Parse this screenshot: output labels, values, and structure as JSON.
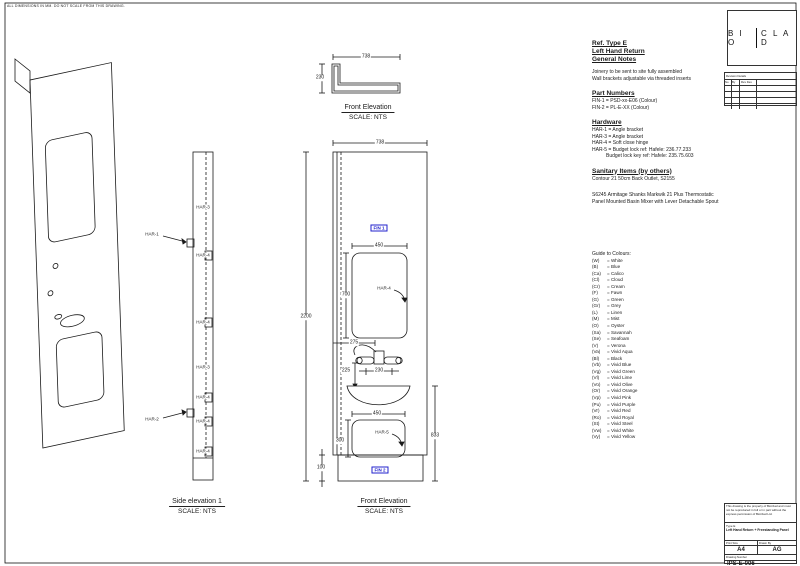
{
  "sheet": {
    "top_note": "ALL DIMENSIONS IN MM. DO NOT SCALE FROM THIS DRAWING."
  },
  "logo": {
    "part1": "B I O",
    "part2": "C L A D"
  },
  "revisions": {
    "title": "Revision Details",
    "col1": "No",
    "col2": "By",
    "col3": "Rev Des"
  },
  "ref_notes": {
    "line1": "Ref. Type E",
    "line2": "Left Hand Return",
    "line3": "General Notes",
    "note1": "Joinery to be sent to site fully assembled",
    "note2": "Wall brackets adjustable via threaded inserts"
  },
  "part_numbers": {
    "title": "Part Numbers",
    "item1": "FIN-1 = PSD-xx-E06 (Colour)",
    "item2": "FIN-2 = PL-E-XX (Colour)"
  },
  "hardware": {
    "title": "Hardware",
    "item1": "HAR-1 = Angle bracket",
    "item2": "HAR-3 = Angle bracket",
    "item3": "HAR-4 = Soft close hinge",
    "item4": "HAR-5 = Budget lock ref: Hafele: 236.77.233",
    "item5": "Budget lock key ref: Hafele: 235.75.603"
  },
  "sanitary": {
    "title": "Sanitary Items (by others)",
    "item1": "Contour 21 50cm Back Outlet, S2155",
    "item2": "S6245 Armitage Shanks Markwik 21 Plus Thermostatic Panel Mounted Basin Mixer with Lever Detachable Spout"
  },
  "colours": {
    "title": "Guide to Colours:",
    "items": [
      {
        "code": "(W)",
        "name": "= White"
      },
      {
        "code": "(B)",
        "name": "= Blue"
      },
      {
        "code": "(Ca)",
        "name": "= Calico"
      },
      {
        "code": "(Cl)",
        "name": "= Cloud"
      },
      {
        "code": "(Cr)",
        "name": "= Cream"
      },
      {
        "code": "(F)",
        "name": "= Fawn"
      },
      {
        "code": "(G)",
        "name": "= Green"
      },
      {
        "code": "(Gr)",
        "name": "= Grey"
      },
      {
        "code": "(L)",
        "name": "= Linen"
      },
      {
        "code": "(M)",
        "name": "= Mist"
      },
      {
        "code": "(O)",
        "name": "= Oyster"
      },
      {
        "code": "(Sa)",
        "name": "= Savannah"
      },
      {
        "code": "(Se)",
        "name": "= Seafoam"
      },
      {
        "code": "(V)",
        "name": "= Verona"
      },
      {
        "code": "(Va)",
        "name": "= Vivid Aqua"
      },
      {
        "code": "(Bl)",
        "name": "= Black"
      },
      {
        "code": "(Vb)",
        "name": "= Vivid Blue"
      },
      {
        "code": "(Vg)",
        "name": "= Vivid Green"
      },
      {
        "code": "(Vl)",
        "name": "= Vivid Lime"
      },
      {
        "code": "(Vo)",
        "name": "= Vivid Olive"
      },
      {
        "code": "(Or)",
        "name": "= Vivid Orange"
      },
      {
        "code": "(Vp)",
        "name": "= Vivid Pink"
      },
      {
        "code": "(Pu)",
        "name": "= Vivid Purple"
      },
      {
        "code": "(Vr)",
        "name": "= Vivid Red"
      },
      {
        "code": "(Ro)",
        "name": "= Vivid Royal"
      },
      {
        "code": "(St)",
        "name": "= Vivid Steel"
      },
      {
        "code": "(Vw)",
        "name": "= Vivid White"
      },
      {
        "code": "(Vy)",
        "name": "= Vivid Yellow"
      }
    ]
  },
  "views": {
    "plan": {
      "caption": "Front Elevation",
      "scale": "SCALE: NTS",
      "dim_width": "738",
      "dim_depth": "230"
    },
    "side": {
      "caption": "Side elevation 1",
      "scale": "SCALE: NTS",
      "leader_top": "HAR-1",
      "leader_bottom": "HAR-2",
      "labels": [
        "HAR-3",
        "HAR-4",
        "HAR-4",
        "HAR-3",
        "HAR-4",
        "HAR-4",
        "HAR-4"
      ]
    },
    "front": {
      "caption": "Front Elevation",
      "scale": "SCALE: NTS",
      "dim_width": "738",
      "dim_height": "2200",
      "dim_cutout1_w": "450",
      "dim_cutout1_h": "700",
      "dim_tap_offset": "275",
      "dim_tap_down": "225",
      "dim_tap_gap": "230",
      "dim_cutout2_w": "450",
      "dim_cutout2_h": "300",
      "dim_basin_height": "833",
      "dim_plinth": "100",
      "label_fin1": "FIN 1",
      "label_fin2": "FIN 2",
      "label_har4": "HAR-4",
      "label_har5": "HAR-5"
    }
  },
  "title_block": {
    "disclaimer": "This drawing is the property of BioClad and must not be reproduced in full or in part without the express permission of BioClad Ltd.",
    "type_label": "Type E",
    "type_desc": "Left Hand Return + Freestanding Panel",
    "print_size_label": "Print Size",
    "drawn_by_label": "Drawn By",
    "print_size": "A4",
    "drawn_by": "AG",
    "drawing_number_label": "Drawing Number",
    "drawing_number": "IPS-E-006"
  },
  "colors": {
    "accent_blue": "#2222cc",
    "line": "#1a1a1a"
  }
}
